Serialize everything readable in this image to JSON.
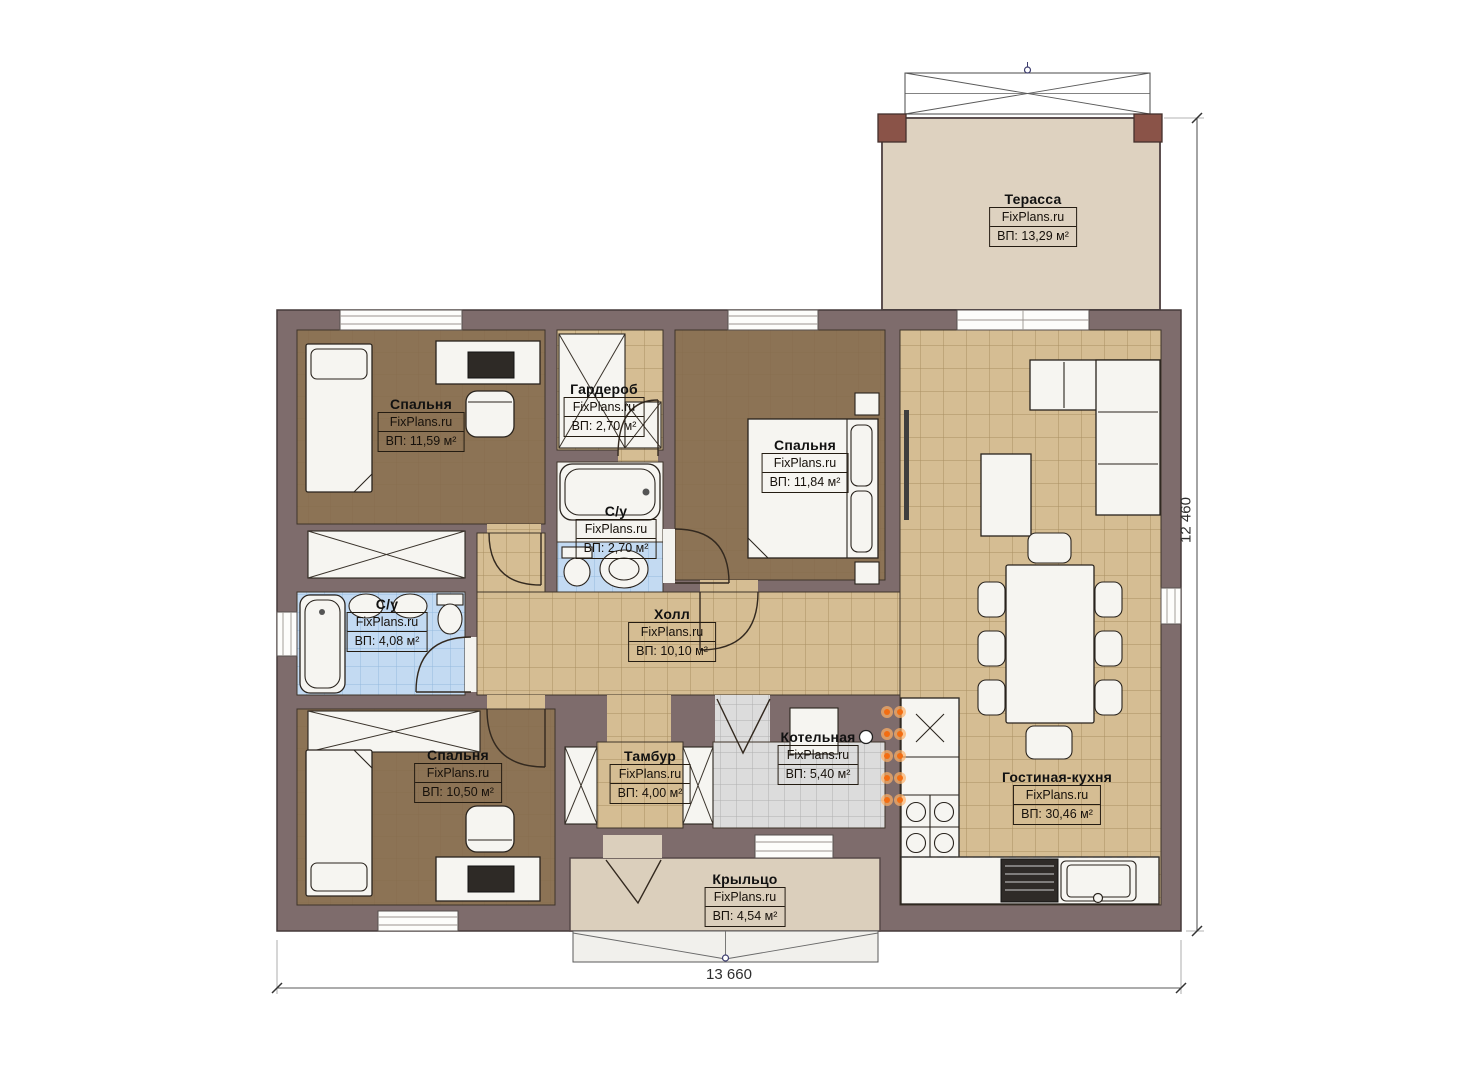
{
  "plan": {
    "brand": "FixPlans.ru",
    "rooms": [
      {
        "id": "terrace",
        "name": "Терасса",
        "area": "ВП: 13,29 м²"
      },
      {
        "id": "bedroom-1",
        "name": "Спальня",
        "area": "ВП: 11,59 м²"
      },
      {
        "id": "wardrobe",
        "name": "Гардероб",
        "area": "ВП: 2,70 м²"
      },
      {
        "id": "bedroom-2",
        "name": "Спальня",
        "area": "ВП: 11,84 м²"
      },
      {
        "id": "bathroom-small",
        "name": "С/у",
        "area": "ВП: 2,70 м²"
      },
      {
        "id": "bathroom-large",
        "name": "С/у",
        "area": "ВП: 4,08 м²"
      },
      {
        "id": "hall",
        "name": "Холл",
        "area": "ВП: 10,10 м²"
      },
      {
        "id": "bedroom-3",
        "name": "Спальня",
        "area": "ВП: 10,50 м²"
      },
      {
        "id": "vestibule",
        "name": "Тамбур",
        "area": "ВП: 4,00 м²"
      },
      {
        "id": "boiler-room",
        "name": "Котельная",
        "area": "ВП: 5,40 м²"
      },
      {
        "id": "living-kitchen",
        "name": "Гостиная-кухня",
        "area": "ВП: 30,46 м²"
      },
      {
        "id": "porch",
        "name": "Крыльцо",
        "area": "ВП: 4,54 м²"
      }
    ],
    "dimensions": {
      "width": "13 660",
      "height": "12 460"
    },
    "colors": {
      "wall": "#7e6c6c",
      "floor_wood": "#8c7355",
      "floor_tile_beige": "#d5bd93",
      "floor_tile_blue": "#c3daf2",
      "floor_tile_gray": "#dcdcdc",
      "terrace": "#ded2c0",
      "accent_dots": "#f26d12"
    }
  }
}
